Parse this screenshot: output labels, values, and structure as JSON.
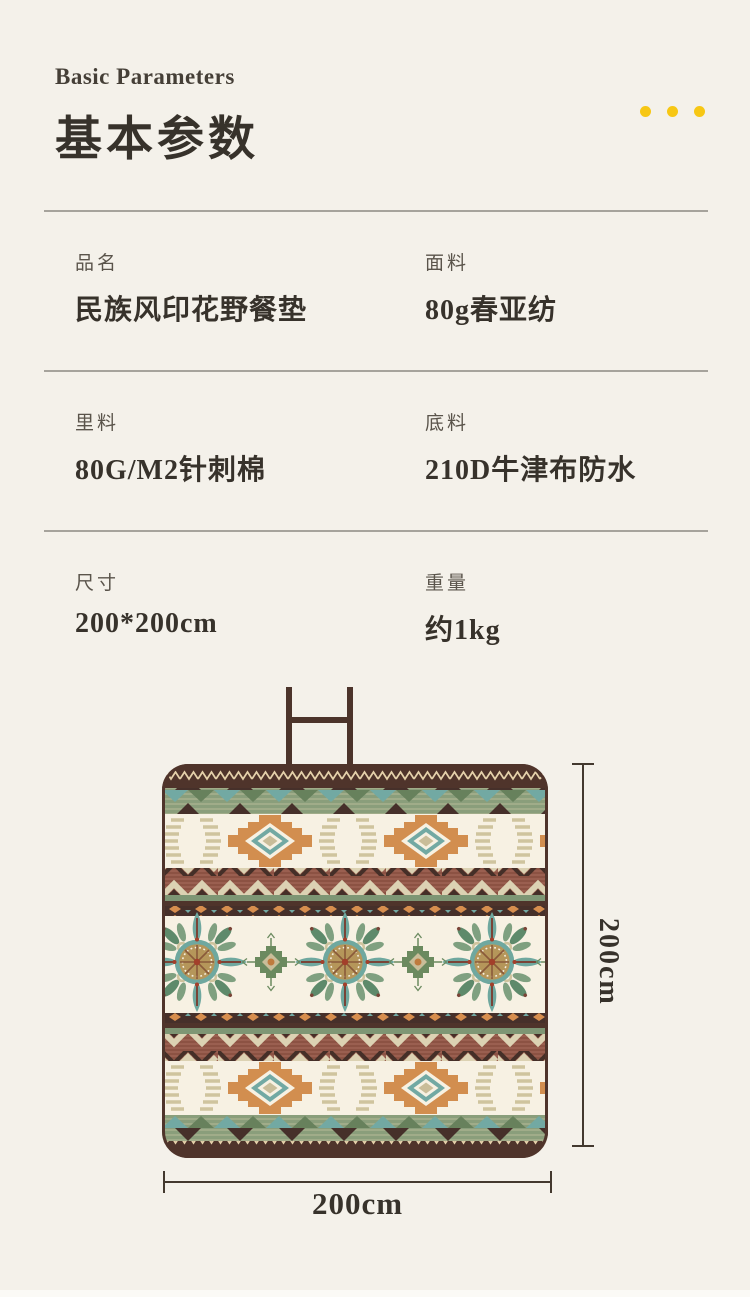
{
  "header": {
    "title_en": "Basic Parameters",
    "title_zh": "基本参数",
    "accent_dots_color": "#f7c714"
  },
  "specs": {
    "rows": [
      {
        "left": {
          "label": "品名",
          "value": "民族风印花野餐垫"
        },
        "right": {
          "label": "面料",
          "value": "80g春亚纺"
        }
      },
      {
        "left": {
          "label": "里料",
          "value": "80G/M2针刺棉"
        },
        "right": {
          "label": "底料",
          "value": "210D牛津布防水"
        }
      },
      {
        "left": {
          "label": "尺寸",
          "value": "200*200cm"
        },
        "right": {
          "label": "重量",
          "value": "约1kg"
        }
      }
    ]
  },
  "figure": {
    "height_label": "200cm",
    "width_label": "200cm",
    "mat_palette": {
      "border_brown": "#4f342b",
      "maroon": "#8c5243",
      "sage_green": "#8a9e7b",
      "teal": "#72a9a3",
      "orange": "#d78e4e",
      "cream": "#f7f1e3",
      "beige": "#cfc49e",
      "dark_triangle": "#46302a"
    }
  }
}
